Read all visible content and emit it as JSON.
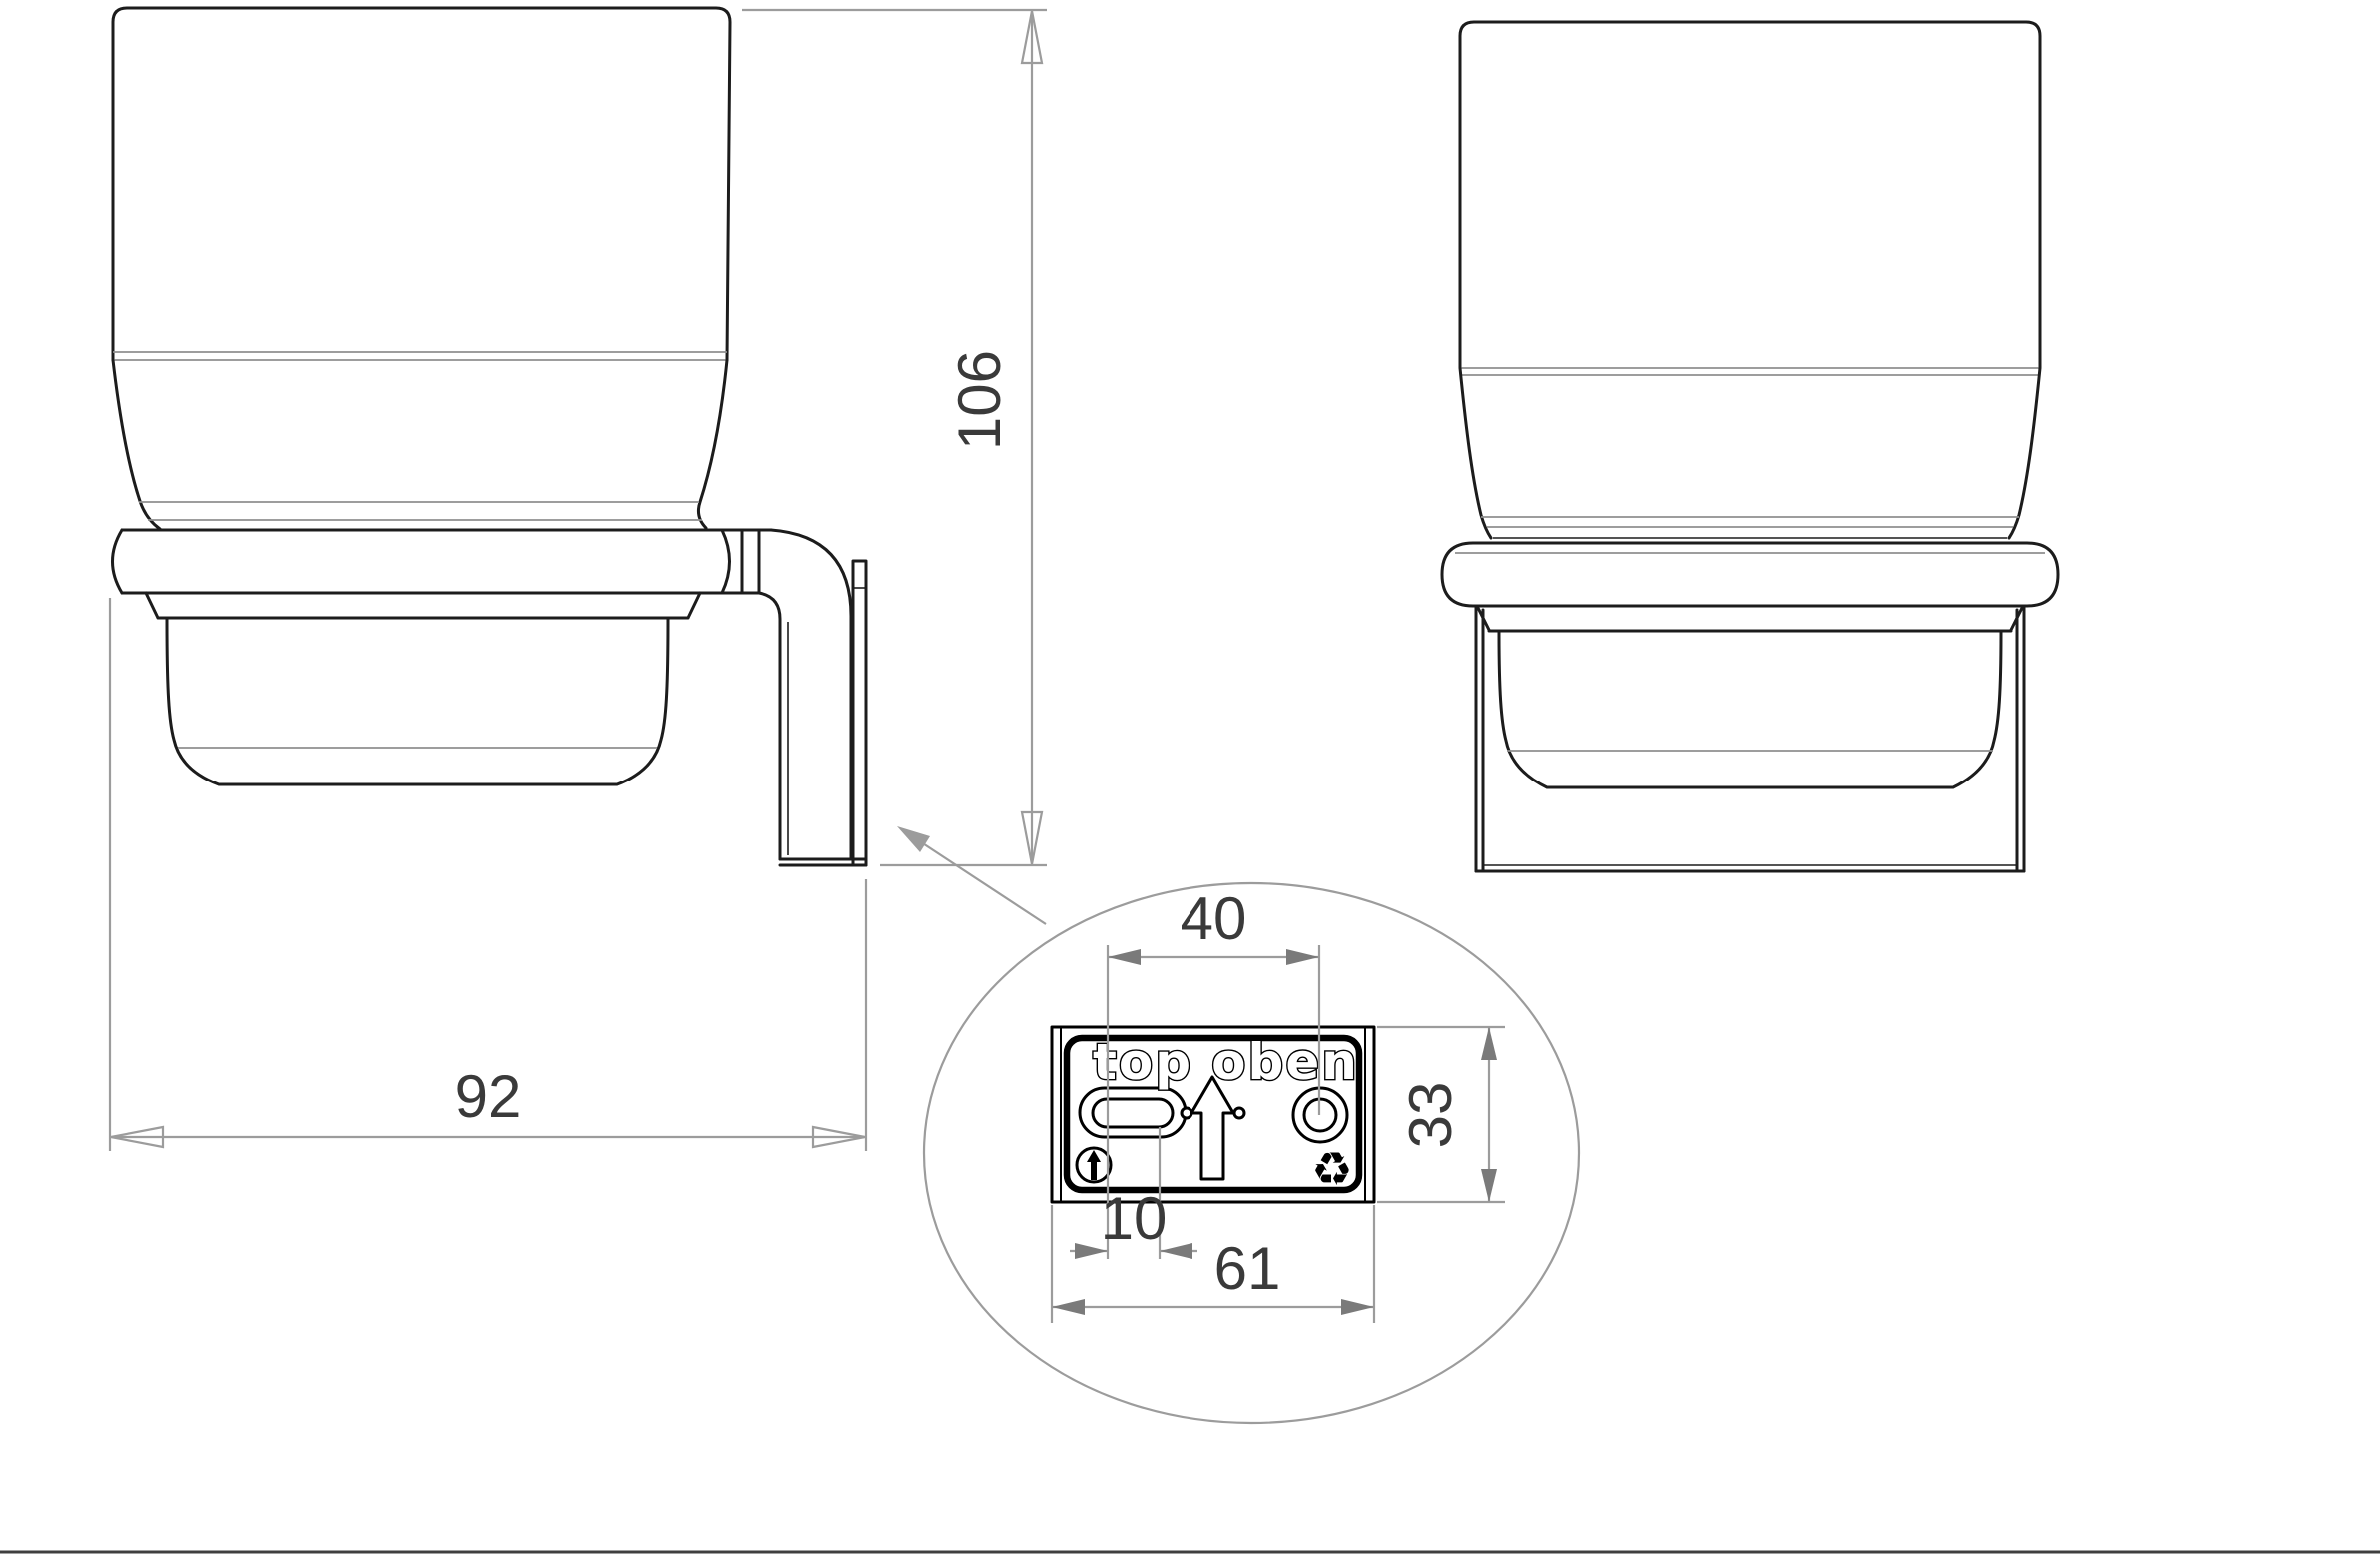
{
  "drawing": {
    "side_view": {
      "height_dim": "106",
      "depth_dim": "92"
    },
    "detail_view": {
      "hole_spacing_dim": "40",
      "plate_height_dim": "33",
      "slot_offset_dim": "10",
      "plate_width_dim": "61",
      "orientation_label_en": "top",
      "orientation_label_de": "oben",
      "recycling_symbol": "♻"
    },
    "colors": {
      "ink": "#1c1c1c",
      "thin": "#8f8f8f",
      "dim": "#9c9c9c",
      "dim_text": "#3a3a3a",
      "arrow": "#7a7a7a",
      "detail_ink": "#000000",
      "background": "#ffffff",
      "border": "#3f3f3f"
    }
  }
}
